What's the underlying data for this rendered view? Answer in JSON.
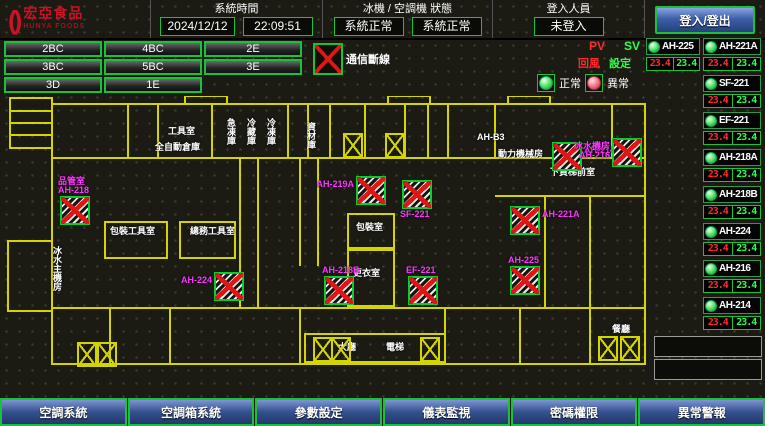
{
  "header": {
    "brand": "宏亞食品",
    "brand_sub": "HUNYA FOODS",
    "system_time_label": "系統時間",
    "date": "2024/12/12",
    "time": "22:09:51",
    "hvac_status_label": "冰機 / 空調機 狀態",
    "chiller_status": "系統正常",
    "ahu_status": "系統正常",
    "login_label": "登入人員",
    "login_status": "未登入",
    "login_button": "登入/登出"
  },
  "floor_buttons": {
    "rows": [
      [
        "2BC",
        "4BC",
        "2E"
      ],
      [
        "3BC",
        "5BC",
        "3E"
      ],
      [
        "3D",
        "1E",
        ""
      ]
    ]
  },
  "legend": {
    "comm_fail_label": "通信斷線",
    "normal_label": "正常",
    "abnormal_label": "異常",
    "pv_label": "PV",
    "sv_label": "SV",
    "return_label": "回風",
    "set_label": "設定"
  },
  "units": {
    "col_a": [
      {
        "name": "AH-225",
        "pv": "23.4",
        "sv": "23.4"
      }
    ],
    "col_b": [
      {
        "name": "AH-221A",
        "pv": "23.4",
        "sv": "23.4"
      },
      {
        "name": "SF-221",
        "pv": "23.4",
        "sv": "23.4"
      },
      {
        "name": "EF-221",
        "pv": "23.4",
        "sv": "23.4"
      },
      {
        "name": "AH-218A",
        "pv": "23.4",
        "sv": "23.4"
      },
      {
        "name": "AH-218B",
        "pv": "23.4",
        "sv": "23.4"
      },
      {
        "name": "AH-224",
        "pv": "23.4",
        "sv": "23.4"
      },
      {
        "name": "AH-216",
        "pv": "23.4",
        "sv": "23.4"
      },
      {
        "name": "AH-214",
        "pv": "23.4",
        "sv": "23.4"
      }
    ],
    "empty_slots": 2
  },
  "map": {
    "room_labels": [
      {
        "text": "工具室",
        "x": 168,
        "y": 30,
        "vertical": false
      },
      {
        "text": "全自動倉庫",
        "x": 155,
        "y": 46,
        "vertical": false
      },
      {
        "text": "急凍庫",
        "x": 226,
        "y": 22,
        "vertical": true
      },
      {
        "text": "冷藏庫",
        "x": 246,
        "y": 22,
        "vertical": true
      },
      {
        "text": "冷凍庫",
        "x": 266,
        "y": 22,
        "vertical": true
      },
      {
        "text": "資材庫",
        "x": 306,
        "y": 26,
        "vertical": true
      },
      {
        "text": "AH-B3",
        "x": 477,
        "y": 36,
        "vertical": false
      },
      {
        "text": "動力機械房",
        "x": 498,
        "y": 53,
        "vertical": false
      },
      {
        "text": "下貨梯前室",
        "x": 550,
        "y": 71,
        "vertical": false
      },
      {
        "text": "包裝工具室",
        "x": 110,
        "y": 130,
        "vertical": false
      },
      {
        "text": "總務工具室",
        "x": 190,
        "y": 130,
        "vertical": false
      },
      {
        "text": "冰水主機房",
        "x": 52,
        "y": 150,
        "vertical": true
      },
      {
        "text": "包裝室",
        "x": 356,
        "y": 126,
        "vertical": false
      },
      {
        "text": "更衣室",
        "x": 353,
        "y": 172,
        "vertical": false
      },
      {
        "text": "大廳",
        "x": 338,
        "y": 246,
        "vertical": false
      },
      {
        "text": "電梯",
        "x": 386,
        "y": 246,
        "vertical": false
      },
      {
        "text": "餐廳",
        "x": 612,
        "y": 228,
        "vertical": false
      }
    ],
    "devices": [
      {
        "label": "品管室",
        "label2": "AH-218",
        "x": 60,
        "y": 100,
        "label_pos": "top"
      },
      {
        "label": "AH-219A",
        "label2": "",
        "x": 356,
        "y": 80,
        "label_pos": "left"
      },
      {
        "label": "SF-221",
        "label2": "",
        "x": 402,
        "y": 84,
        "label_pos": "bottom"
      },
      {
        "label": "AH-214",
        "label2": "",
        "x": 552,
        "y": 46,
        "label_pos": "right"
      },
      {
        "label": "冰水機房",
        "label2": "AH-216",
        "x": 612,
        "y": 42,
        "label_pos": "left"
      },
      {
        "label": "AH-224",
        "label2": "",
        "x": 214,
        "y": 176,
        "label_pos": "left"
      },
      {
        "label": "AH-218B",
        "label2": "",
        "x": 324,
        "y": 180,
        "label_pos": "top"
      },
      {
        "label": "EF-221",
        "label2": "",
        "x": 408,
        "y": 180,
        "label_pos": "top"
      },
      {
        "label": "AH-221A",
        "label2": "",
        "x": 510,
        "y": 110,
        "label_pos": "right"
      },
      {
        "label": "AH-225",
        "label2": "",
        "x": 510,
        "y": 170,
        "label_pos": "top"
      }
    ],
    "elevators": [
      {
        "x": 343,
        "y": 37
      },
      {
        "x": 385,
        "y": 37
      },
      {
        "x": 313,
        "y": 241
      },
      {
        "x": 331,
        "y": 241
      },
      {
        "x": 420,
        "y": 241
      },
      {
        "x": 77,
        "y": 246
      },
      {
        "x": 97,
        "y": 246
      },
      {
        "x": 598,
        "y": 240
      },
      {
        "x": 620,
        "y": 240
      }
    ]
  },
  "footer": {
    "buttons": [
      "空調系統",
      "空調箱系統",
      "參數設定",
      "儀表監視",
      "密碼權限",
      "異常警報"
    ]
  },
  "colors": {
    "wall_yellow": "#d4d400",
    "accent_green": "#19c13d",
    "magenta": "#ff35ff",
    "pv_red": "#ff2c2c",
    "sv_green": "#2dff4e",
    "button_blue": "#3c5fa8",
    "brand_red": "#cf1126"
  }
}
